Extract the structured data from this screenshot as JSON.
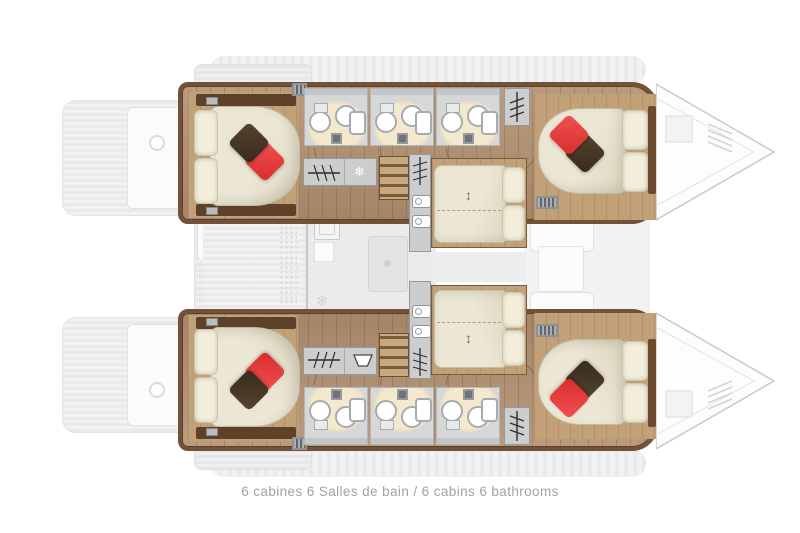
{
  "caption": {
    "text": "6 cabines 6 Salles de bain / 6 cabins 6 bathrooms"
  },
  "glyphs": {
    "snowflake": "❄",
    "double_arrow": "↕"
  },
  "colors": {
    "accent_red": "#d92b2b",
    "pillow_dark": "#382b1c",
    "wood_floor": "#b29070",
    "wood_trim": "#74523a",
    "bed_cream": "#ece6d4",
    "bathroom_floor": "#d5d7d9",
    "shower_mat": "#f4e9ce",
    "ghost_deck": "#efeff1",
    "caption_text": "#a2a2a2"
  }
}
